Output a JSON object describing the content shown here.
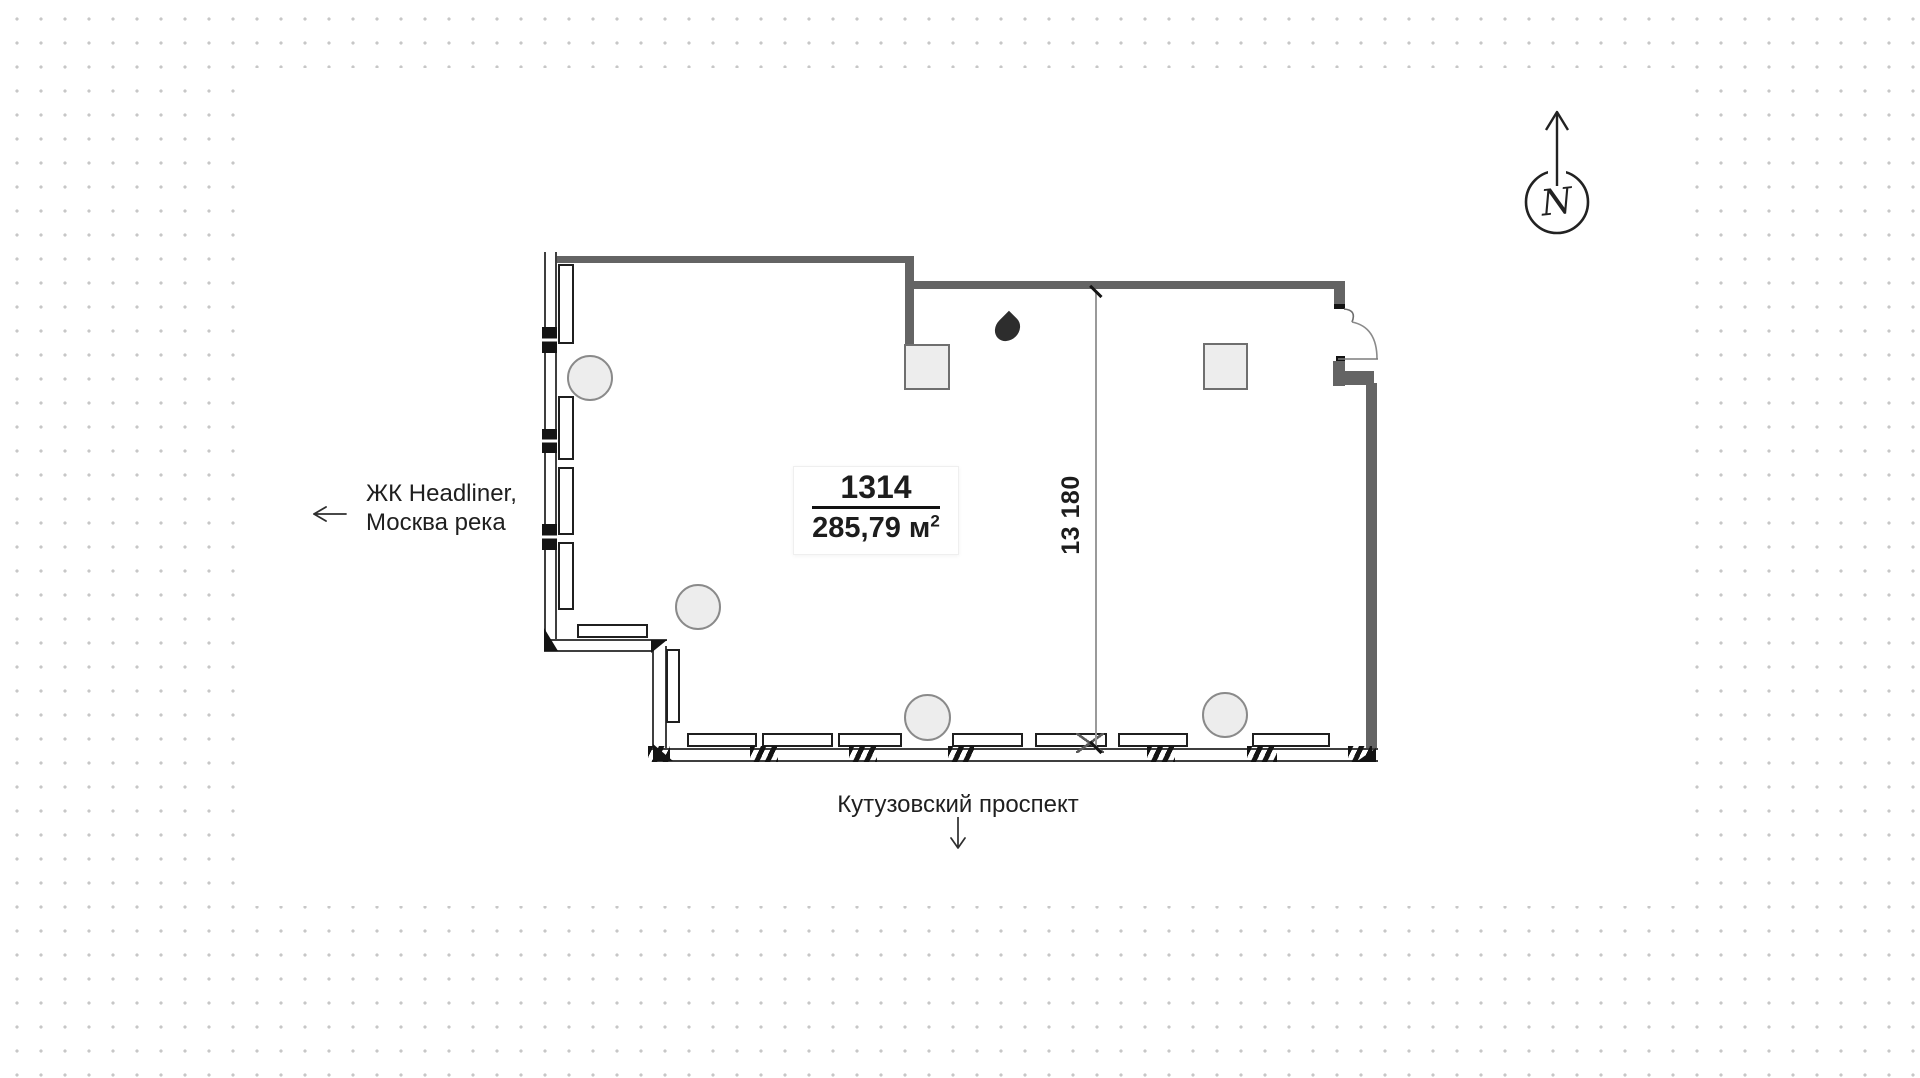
{
  "page": {
    "type": "residential floor plan viewer"
  },
  "colors": {
    "wall": "#646464",
    "line": "#1f1f1f",
    "light_fill": "#ededed",
    "dot_grid": "#c7c7c7",
    "ink": "#1d1d1d"
  },
  "unit_card": {
    "number": "1314",
    "area_value": "285,79",
    "area_unit": "м",
    "area_exponent": "2"
  },
  "dimension": {
    "value": "13 180"
  },
  "labels": {
    "west": {
      "line1": "ЖК Headliner,",
      "line2": "Москва река",
      "icon": "arrow-left-icon"
    },
    "south": {
      "text": "Кутузовский проспект",
      "icon": "arrow-down-icon"
    }
  },
  "compass": {
    "label": "N",
    "icon": "north-compass-icon"
  },
  "plan_icons": {
    "wet_point": "water-drop-icon",
    "door": "door-swing-icon",
    "round_column": "round-column",
    "square_column": "square-column"
  }
}
